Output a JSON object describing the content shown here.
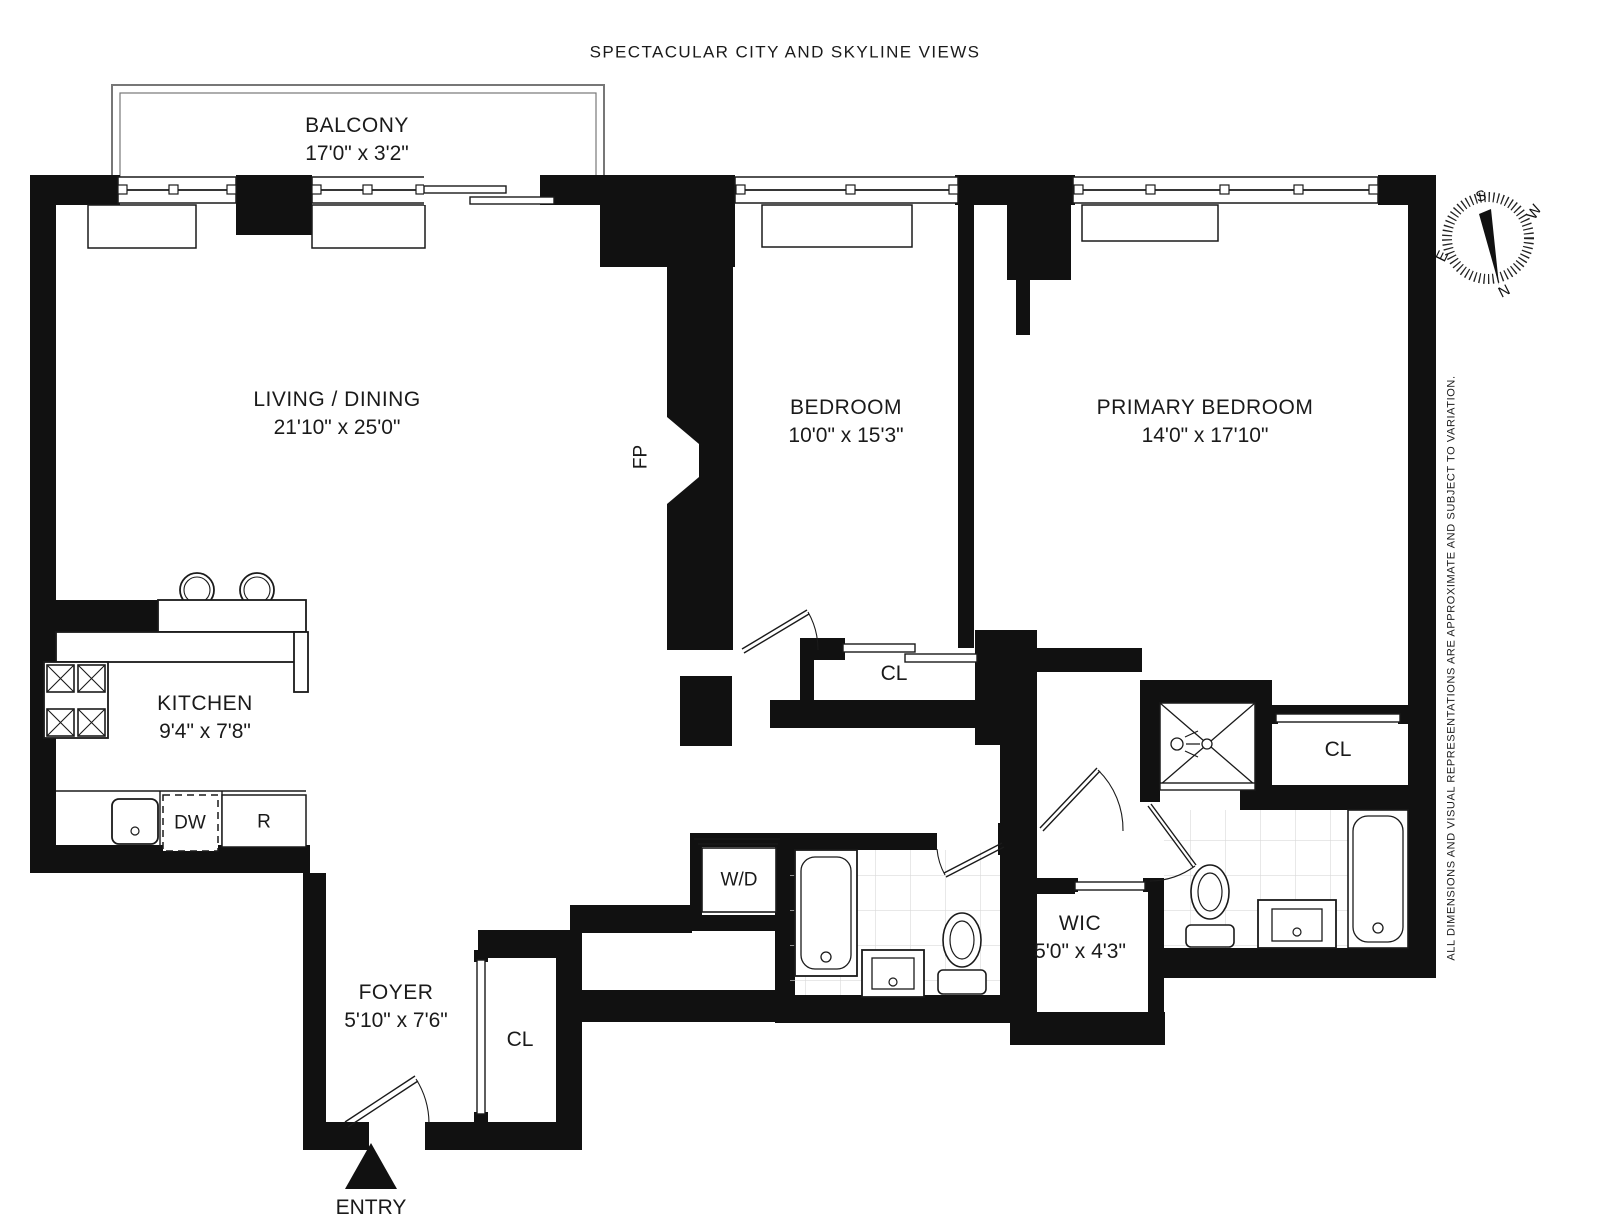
{
  "title": "SPECTACULAR CITY AND SKYLINE VIEWS",
  "disclaimer": "ALL DIMENSIONS AND VISUAL REPRESENTATIONS ARE APPROXIMATE AND SUBJECT TO VARIATION.",
  "entry_label": "ENTRY",
  "rooms": {
    "balcony": {
      "name": "BALCONY",
      "dims": "17'0\" x 3'2\""
    },
    "living": {
      "name": "LIVING / DINING",
      "dims": "21'10\" x 25'0\""
    },
    "bedroom": {
      "name": "BEDROOM",
      "dims": "10'0\" x 15'3\""
    },
    "primary": {
      "name": "PRIMARY BEDROOM",
      "dims": "14'0\" x 17'10\""
    },
    "kitchen": {
      "name": "KITCHEN",
      "dims": "9'4\" x 7'8\""
    },
    "foyer": {
      "name": "FOYER",
      "dims": "5'10\" x 7'6\""
    },
    "wic": {
      "name": "WIC",
      "dims": "5'0\" x 4'3\""
    }
  },
  "labels": {
    "closet": "CL",
    "washer_dryer": "W/D",
    "dishwasher": "DW",
    "refrigerator": "R",
    "fireplace": "FP"
  },
  "compass": {
    "n": "N",
    "s": "S",
    "e": "E",
    "w": "W"
  },
  "colors": {
    "wall": "#111111",
    "line": "#1a1a1a",
    "tile": "#d9d9d9",
    "balcony_line": "#777777"
  }
}
